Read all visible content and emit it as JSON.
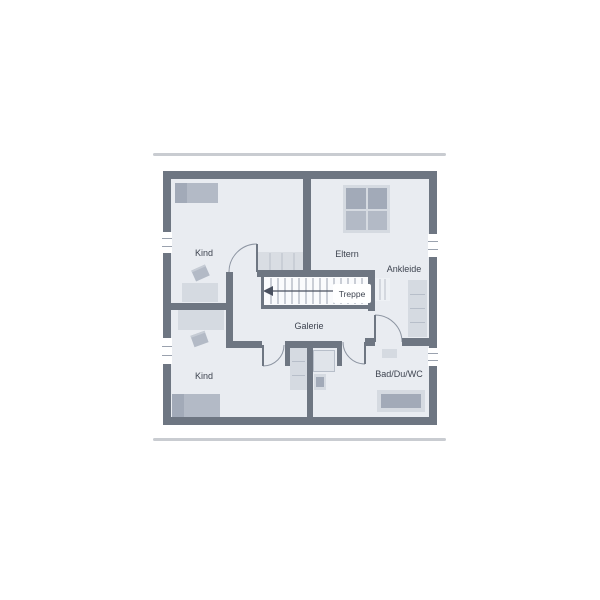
{
  "plan": {
    "type": "floor-plan",
    "rooms": {
      "kind_top": {
        "label": "Kind"
      },
      "eltern": {
        "label": "Eltern"
      },
      "ankleide": {
        "label": "Ankleide"
      },
      "treppe": {
        "label": "Treppe"
      },
      "galerie": {
        "label": "Galerie"
      },
      "kind_bottom": {
        "label": "Kind"
      },
      "bad": {
        "label": "Bad/Du/WC"
      }
    }
  },
  "palette": {
    "wall": "#6e7682",
    "floor": "#e9ecf1",
    "furniture_light": "#d5dae1",
    "furniture_mid": "#b3bac6",
    "furniture_dark": "#a2aab8",
    "stair_tread_line": "#9aa2ae",
    "door_arc": "#8d95a2",
    "stair_arrow": "#4a5160",
    "label_text": "#3e4450",
    "rule_line": "#c9ccd1"
  }
}
